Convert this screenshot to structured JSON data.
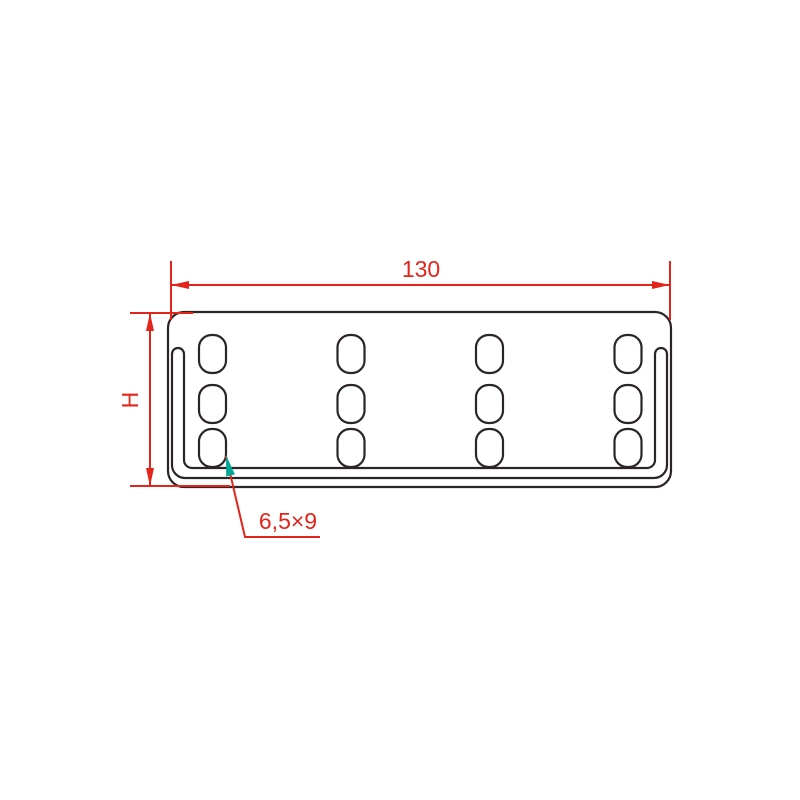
{
  "labels": {
    "width": "130",
    "height": "H",
    "slot_size": "6,5×9"
  },
  "colors": {
    "background": "#ffffff",
    "outline": "#2b2528",
    "dimension_red": "#e2241b",
    "leader_arrow_teal": "#00a693"
  },
  "geometry": {
    "plate": {
      "x": 168,
      "y": 312,
      "width": 503,
      "height": 175,
      "corner_radius": 16
    },
    "fold_band": {
      "path": "M 172 354 A 6 6 0 0 1 184 354 L 184 460 A 8 8 0 0 0 192 468 L 647 468 A 8 8 0 0 0 655 460 L 655 354 A 6 6 0 0 1 667 354 L 667 465 A 13 13 0 0 1 654 478 L 185 478 A 13 13 0 0 1 172 465 Z"
    },
    "slots": {
      "columns_cx": [
        212.5,
        351,
        489.5,
        628
      ],
      "rows_cy": [
        354,
        404,
        448
      ],
      "width": 27,
      "height": 38,
      "corner_radius": 12.5,
      "count": 12
    },
    "width_dimension": {
      "line": {
        "x1": 171,
        "y1": 285,
        "x2": 670,
        "y2": 285
      },
      "extension_lines": [
        {
          "x1": 171,
          "y1": 261,
          "x2": 171,
          "y2": 320
        },
        {
          "x1": 670,
          "y1": 261,
          "x2": 670,
          "y2": 320
        }
      ],
      "arrows": [
        "171,285 189,281 189,289",
        "670,285 652,281 652,289"
      ],
      "label_x": 421,
      "label_y": 277
    },
    "height_dimension": {
      "line": {
        "x1": 150,
        "y1": 313,
        "x2": 150,
        "y2": 486
      },
      "extension_lines": [
        {
          "x1": 130,
          "y1": 313,
          "x2": 193,
          "y2": 313
        },
        {
          "x1": 130,
          "y1": 486,
          "x2": 230,
          "y2": 486
        }
      ],
      "arrows": [
        "150,313 146,331 154,331",
        "150,486 146,468 154,468"
      ],
      "label_x": 138,
      "label_y": 400
    },
    "callout": {
      "leader_points": "226,456 245,537 320,537",
      "arrow_points": "226,455 234.9,474.4 226.2,476.5",
      "label_x": 288,
      "label_y": 529
    }
  }
}
